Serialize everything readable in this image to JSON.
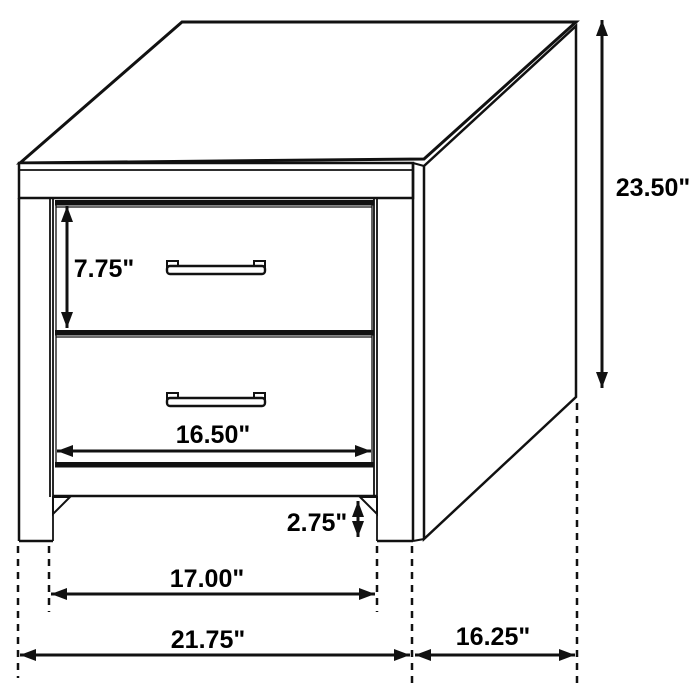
{
  "diagram": {
    "title": "Two-drawer nightstand dimension diagram",
    "units": "inches",
    "style": "black line technical drawing on white background"
  },
  "dimensions": {
    "overall_height": "23.50\"",
    "top_drawer_height": "7.75\"",
    "drawer_front_width": "16.50\"",
    "floor_clearance": "2.75\"",
    "inner_leg_span": "17.00\"",
    "overall_width": "21.75\"",
    "side_depth": "16.25\""
  },
  "colors": {
    "line": "#111111",
    "background": "#ffffff",
    "text": "#000000"
  }
}
